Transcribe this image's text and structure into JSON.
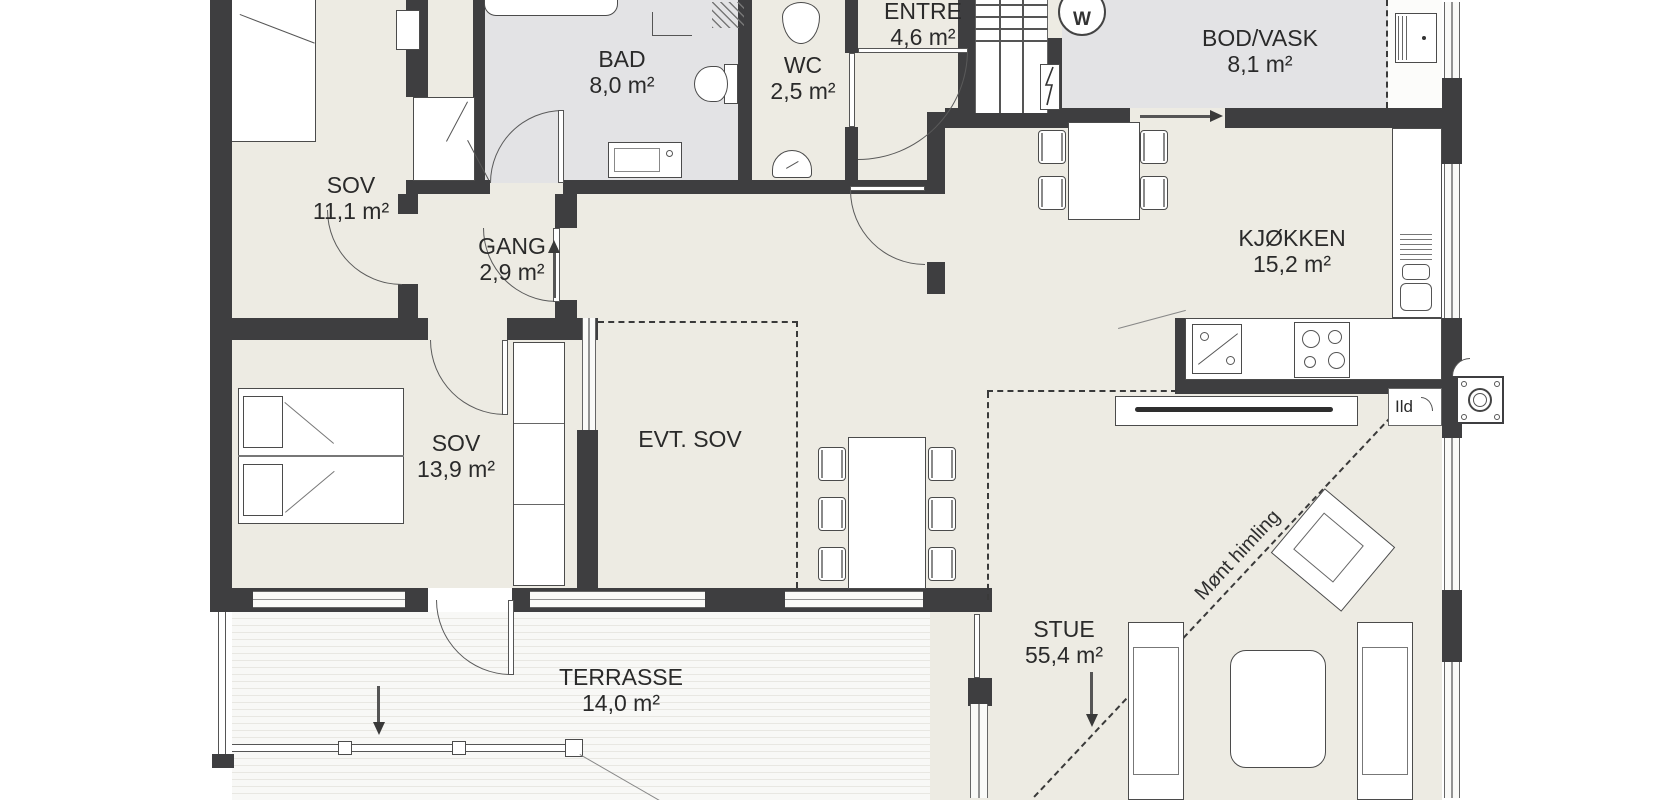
{
  "plan": {
    "type": "floor-plan",
    "language": "Norwegian",
    "rooms": {
      "sov1": {
        "name": "SOV",
        "area": "11,1 m²"
      },
      "bad": {
        "name": "BAD",
        "area": "8,0 m²"
      },
      "wc": {
        "name": "WC",
        "area": "2,5 m²"
      },
      "entre": {
        "name": "ENTRE",
        "area": "4,6 m²"
      },
      "bod_vask": {
        "name": "BOD/VASK",
        "area": "8,1 m²"
      },
      "kjokken": {
        "name": "KJØKKEN",
        "area": "15,2 m²"
      },
      "gang": {
        "name": "GANG",
        "area": "2,9 m²"
      },
      "sov2": {
        "name": "SOV",
        "area": "13,9 m²"
      },
      "evt_sov": {
        "name": "EVT. SOV",
        "area": ""
      },
      "stue": {
        "name": "STUE",
        "area": "55,4 m²"
      },
      "terrasse": {
        "name": "TERRASSE",
        "area": "14,0 m²"
      }
    },
    "annotations": {
      "fireplace": "Ild",
      "ceiling": "Mønt himling",
      "washer": "W"
    },
    "colors": {
      "wall": "#3e3e40",
      "floor": "#edebe3",
      "wet_room_floor": "#e3e3e5",
      "background": "#ffffff"
    }
  }
}
